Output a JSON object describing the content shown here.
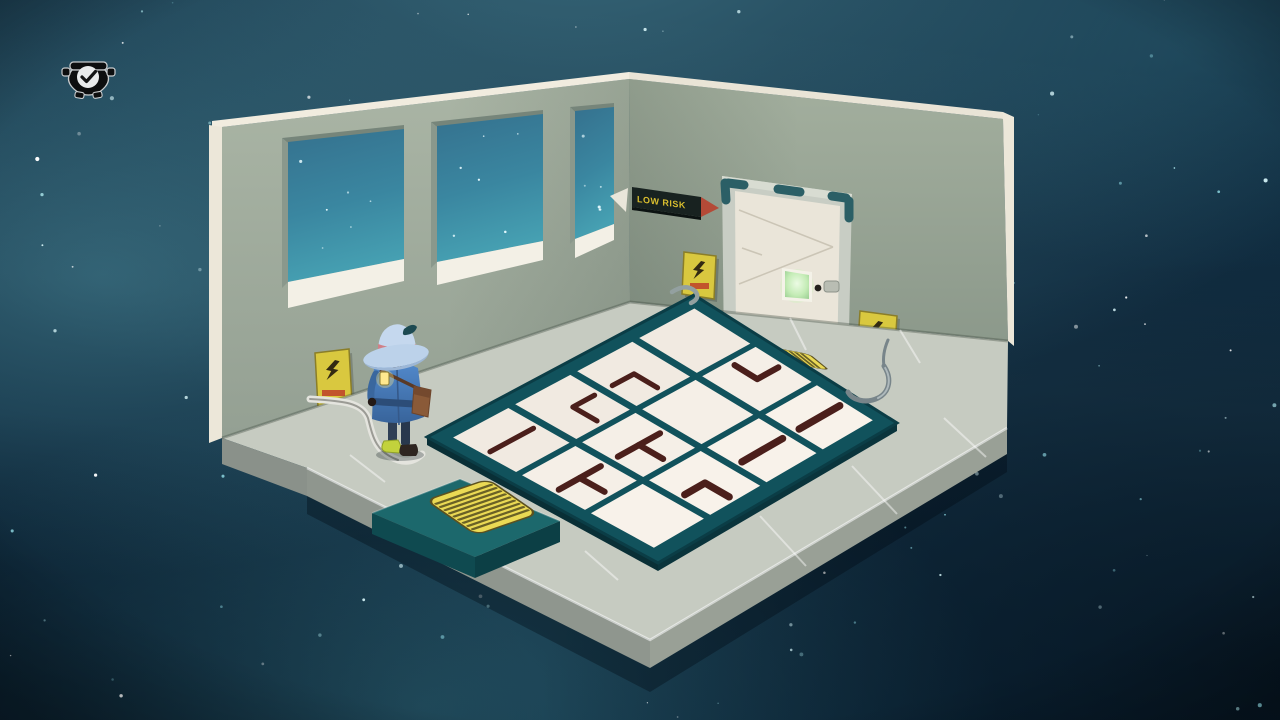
{
  "hud": {
    "achievement_icon": "cauldron-check-icon"
  },
  "room": {
    "door_sign": {
      "text": "LOW RISK",
      "arrow": "right"
    },
    "warning_signs": [
      {
        "id": "left-wall",
        "glyph": "lightning-bolt"
      },
      {
        "id": "beside-door",
        "glyph": "lightning-bolt"
      },
      {
        "id": "far-right-wall",
        "glyph": "lightning-bolt"
      }
    ],
    "window_count": 3
  },
  "puzzle": {
    "rows": 3,
    "cols": 4,
    "legend": {
      "line": "straight path",
      "corner": "corner path",
      "tee": "T-junction path",
      "blank": "empty tile"
    },
    "tiles": [
      {
        "r": 0,
        "c": 0,
        "piece": "line",
        "connects": [
          "SW",
          "NE"
        ]
      },
      {
        "r": 0,
        "c": 1,
        "piece": "corner",
        "connects": [
          "NE",
          "SE"
        ]
      },
      {
        "r": 0,
        "c": 2,
        "piece": "corner",
        "connects": [
          "SW",
          "SE"
        ]
      },
      {
        "r": 0,
        "c": 3,
        "piece": "blank",
        "connects": []
      },
      {
        "r": 1,
        "c": 0,
        "piece": "tee",
        "connects": [
          "SW",
          "NE",
          "SE"
        ]
      },
      {
        "r": 1,
        "c": 1,
        "piece": "tee",
        "connects": [
          "SW",
          "NE",
          "SE"
        ]
      },
      {
        "r": 1,
        "c": 2,
        "piece": "blank",
        "connects": []
      },
      {
        "r": 1,
        "c": 3,
        "piece": "corner",
        "connects": [
          "NW",
          "NE"
        ]
      },
      {
        "r": 2,
        "c": 0,
        "piece": "blank",
        "connects": []
      },
      {
        "r": 2,
        "c": 1,
        "piece": "corner",
        "connects": [
          "SW",
          "SE"
        ]
      },
      {
        "r": 2,
        "c": 2,
        "piece": "line",
        "connects": [
          "SW",
          "NE"
        ]
      },
      {
        "r": 2,
        "c": 3,
        "piece": "line",
        "connects": [
          "SW",
          "NE"
        ]
      }
    ]
  },
  "palette": {
    "nebula_base": "#0a2438",
    "nebula_glow": "#3c7d91",
    "star": "#cfeef2",
    "wall": "#a0ac9c",
    "wall_trim": "#f1ecdf",
    "floor": "#c6cbc1",
    "floor_side": "#8f968e",
    "window_glass": "#3f8ba4",
    "tray_teal": "#11525c",
    "tile_white": "#f5efe7",
    "path_stroke": "#4b1f1b",
    "mat_yellow": "#ead954",
    "sign_yellow": "#d9c83f",
    "sign_caption_red": "#c2542c",
    "door_leaf": "#eae5d9",
    "door_frame": "#c8cdc4",
    "frame_accent": "#2b5f66",
    "screen_green": "#cdf2c2",
    "arrow_red": "#b44a37",
    "sign_text_yellow": "#d8bd2e",
    "slab_teal": "#1c686c",
    "coat_blue": "#4d82c4",
    "hat_blue": "#c0d4ec",
    "lantern_yellow": "#ffe98e",
    "boot_green": "#c2d23c"
  }
}
